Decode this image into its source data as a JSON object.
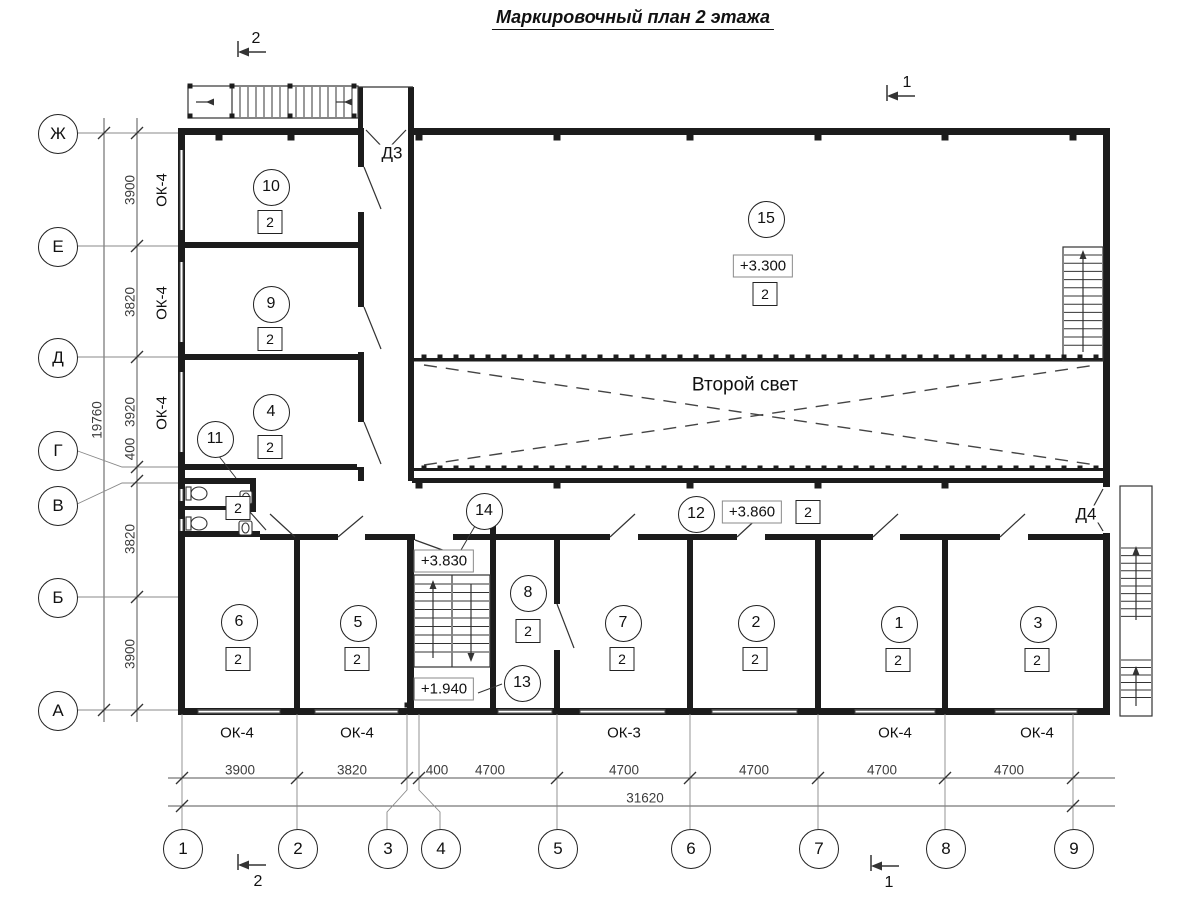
{
  "title": "Маркировочный план 2 этажа",
  "plan": {
    "axes_left": [
      {
        "label": "Ж",
        "cx": 57,
        "cy": 133
      },
      {
        "label": "Е",
        "cx": 57,
        "cy": 246
      },
      {
        "label": "Д",
        "cx": 57,
        "cy": 357
      },
      {
        "label": "Г",
        "cx": 57,
        "cy": 450
      },
      {
        "label": "В",
        "cx": 57,
        "cy": 505
      },
      {
        "label": "Б",
        "cx": 57,
        "cy": 597
      },
      {
        "label": "А",
        "cx": 57,
        "cy": 710
      }
    ],
    "axes_bottom": [
      {
        "label": "1",
        "cx": 182,
        "cy": 848
      },
      {
        "label": "2",
        "cx": 297,
        "cy": 848
      },
      {
        "label": "3",
        "cx": 387,
        "cy": 848
      },
      {
        "label": "4",
        "cx": 440,
        "cy": 848
      },
      {
        "label": "5",
        "cx": 557,
        "cy": 848
      },
      {
        "label": "6",
        "cx": 690,
        "cy": 848
      },
      {
        "label": "7",
        "cx": 818,
        "cy": 848
      },
      {
        "label": "8",
        "cx": 945,
        "cy": 848
      },
      {
        "label": "9",
        "cx": 1073,
        "cy": 848
      }
    ],
    "dims_left": [
      {
        "value": "3900",
        "x": 130,
        "y": 190
      },
      {
        "value": "3820",
        "x": 130,
        "y": 302
      },
      {
        "value": "3920",
        "x": 130,
        "y": 412
      },
      {
        "value": "400",
        "x": 130,
        "y": 449
      },
      {
        "value": "3820",
        "x": 130,
        "y": 539
      },
      {
        "value": "3900",
        "x": 130,
        "y": 654
      }
    ],
    "dim_left_total": {
      "value": "19760",
      "x": 97,
      "y": 420
    },
    "dims_bottom": [
      {
        "value": "3900",
        "x": 240,
        "y": 770
      },
      {
        "value": "3820",
        "x": 352,
        "y": 770
      },
      {
        "value": "400",
        "x": 437,
        "y": 770
      },
      {
        "value": "4700",
        "x": 490,
        "y": 770
      },
      {
        "value": "4700",
        "x": 624,
        "y": 770
      },
      {
        "value": "4700",
        "x": 754,
        "y": 770
      },
      {
        "value": "4700",
        "x": 882,
        "y": 770
      },
      {
        "value": "4700",
        "x": 1009,
        "y": 770
      }
    ],
    "dim_bottom_total": {
      "value": "31620",
      "x": 645,
      "y": 798
    },
    "rooms": [
      {
        "number": "10",
        "cx": 270,
        "cy": 186,
        "badge": "2",
        "bcx": 270,
        "bcy": 222
      },
      {
        "number": "9",
        "cx": 270,
        "cy": 303,
        "badge": "2",
        "bcx": 270,
        "bcy": 339
      },
      {
        "number": "4",
        "cx": 270,
        "cy": 411,
        "badge": "2",
        "bcx": 270,
        "bcy": 447
      },
      {
        "number": "11",
        "cx": 214,
        "cy": 438
      },
      {
        "number": "15",
        "cx": 765,
        "cy": 218,
        "badge": "2",
        "bcx": 765,
        "bcy": 294
      },
      {
        "number": "14",
        "cx": 483,
        "cy": 510
      },
      {
        "number": "12",
        "cx": 695,
        "cy": 513
      },
      {
        "number": "8",
        "cx": 527,
        "cy": 592,
        "badge": "2",
        "bcx": 528,
        "bcy": 631
      },
      {
        "number": "13",
        "cx": 521,
        "cy": 682
      },
      {
        "number": "6",
        "cx": 238,
        "cy": 621,
        "badge": "2",
        "bcx": 238,
        "bcy": 659
      },
      {
        "number": "5",
        "cx": 357,
        "cy": 622,
        "badge": "2",
        "bcx": 357,
        "bcy": 659
      },
      {
        "number": "7",
        "cx": 622,
        "cy": 622,
        "badge": "2",
        "bcx": 622,
        "bcy": 659
      },
      {
        "number": "2",
        "cx": 755,
        "cy": 622,
        "badge": "2",
        "bcx": 755,
        "bcy": 659
      },
      {
        "number": "1",
        "cx": 898,
        "cy": 623,
        "badge": "2",
        "bcx": 898,
        "bcy": 660
      },
      {
        "number": "3",
        "cx": 1037,
        "cy": 623,
        "badge": "2",
        "bcx": 1037,
        "bcy": 660
      }
    ],
    "standalone_badges": [
      {
        "value": "2",
        "cx": 238,
        "cy": 508
      },
      {
        "value": "2",
        "cx": 808,
        "cy": 512
      }
    ],
    "elevations": [
      {
        "value": "+3.300",
        "cx": 763,
        "cy": 266
      },
      {
        "value": "+3.830",
        "cx": 444,
        "cy": 561
      },
      {
        "value": "+1.940",
        "cx": 444,
        "cy": 689
      },
      {
        "value": "+3.860",
        "cx": 752,
        "cy": 512
      }
    ],
    "window_labels": [
      {
        "value": "ОК-4",
        "cx": 237,
        "cy": 733,
        "rot": false
      },
      {
        "value": "ОК-4",
        "cx": 357,
        "cy": 733,
        "rot": false
      },
      {
        "value": "ОК-3",
        "cx": 624,
        "cy": 733,
        "rot": false
      },
      {
        "value": "ОК-4",
        "cx": 895,
        "cy": 733,
        "rot": false
      },
      {
        "value": "ОК-4",
        "cx": 1037,
        "cy": 733,
        "rot": false
      },
      {
        "value": "ОК-4",
        "cx": 162,
        "cy": 190,
        "rot": true
      },
      {
        "value": "ОК-4",
        "cx": 162,
        "cy": 303,
        "rot": true
      },
      {
        "value": "ОК-4",
        "cx": 162,
        "cy": 413,
        "rot": true
      }
    ],
    "door_labels": [
      {
        "value": "Д3",
        "cx": 392,
        "cy": 153
      },
      {
        "value": "Д4",
        "cx": 1086,
        "cy": 514
      }
    ],
    "void_label": {
      "value": "Второй свет",
      "cx": 745,
      "cy": 385
    },
    "section_marks": [
      {
        "label": "2",
        "tx": 256,
        "ty": 39
      },
      {
        "label": "1",
        "tx": 907,
        "ty": 83
      },
      {
        "label": "2",
        "tx": 258,
        "ty": 882
      },
      {
        "label": "1",
        "tx": 889,
        "ty": 883
      }
    ]
  }
}
